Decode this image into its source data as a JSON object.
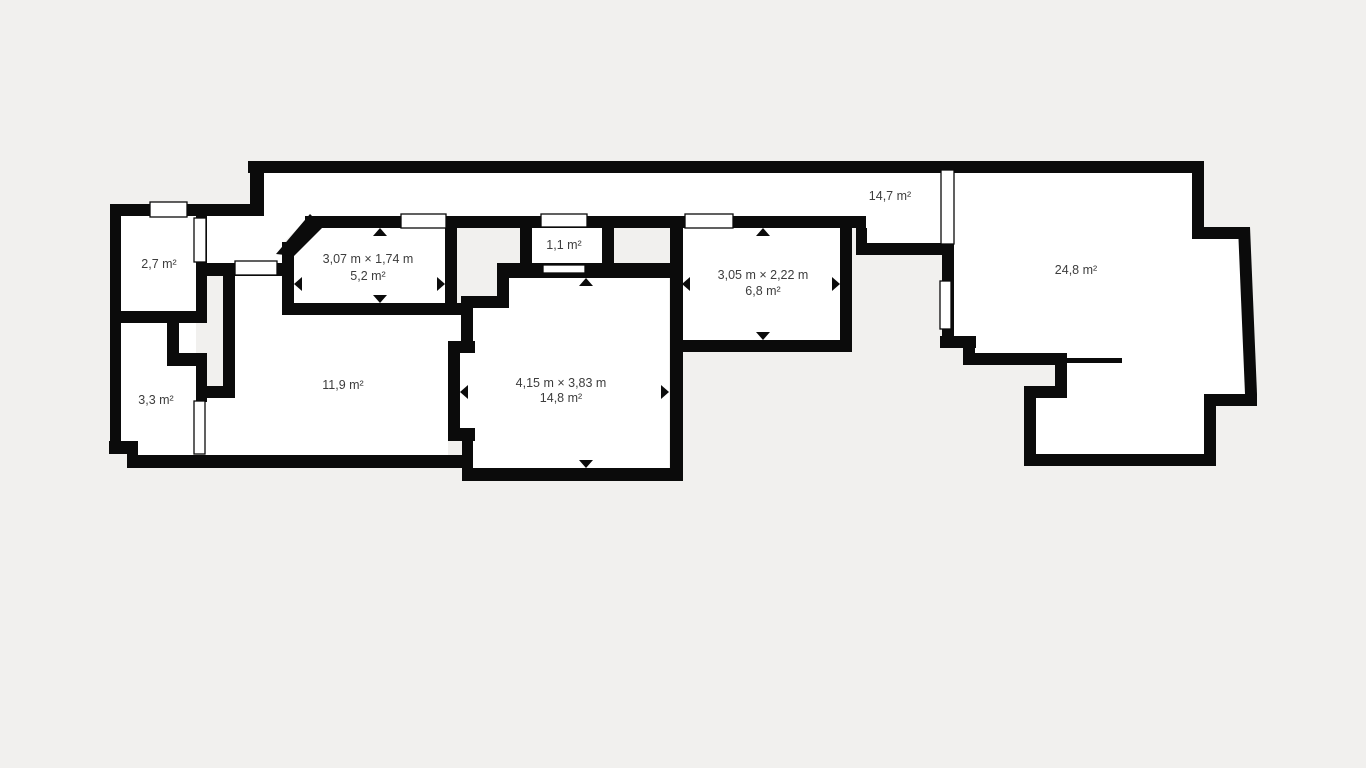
{
  "colors": {
    "wall": "#0b0b0b",
    "room": "#ffffff",
    "door_fill": "#ffffff",
    "label": "#3d3d3d",
    "background": "#f1f0ee"
  },
  "floorplan": {
    "rooms": [
      {
        "id": "room-2-7",
        "area": "2,7 m²"
      },
      {
        "id": "room-3-3",
        "area": "3,3 m²"
      },
      {
        "id": "room-11-9",
        "area": "11,9 m²"
      },
      {
        "id": "room-5-2",
        "dimensions": "3,07 m × 1,74 m",
        "area": "5,2 m²"
      },
      {
        "id": "room-1-1",
        "area": "1,1 m²"
      },
      {
        "id": "room-14-8",
        "dimensions": "4,15 m × 3,83 m",
        "area": "14,8 m²"
      },
      {
        "id": "room-6-8",
        "dimensions": "3,05 m × 2,22 m",
        "area": "6,8 m²"
      },
      {
        "id": "corridor-14-7",
        "area": "14,7 m²"
      },
      {
        "id": "room-24-8",
        "area": "24,8 m²"
      }
    ]
  }
}
